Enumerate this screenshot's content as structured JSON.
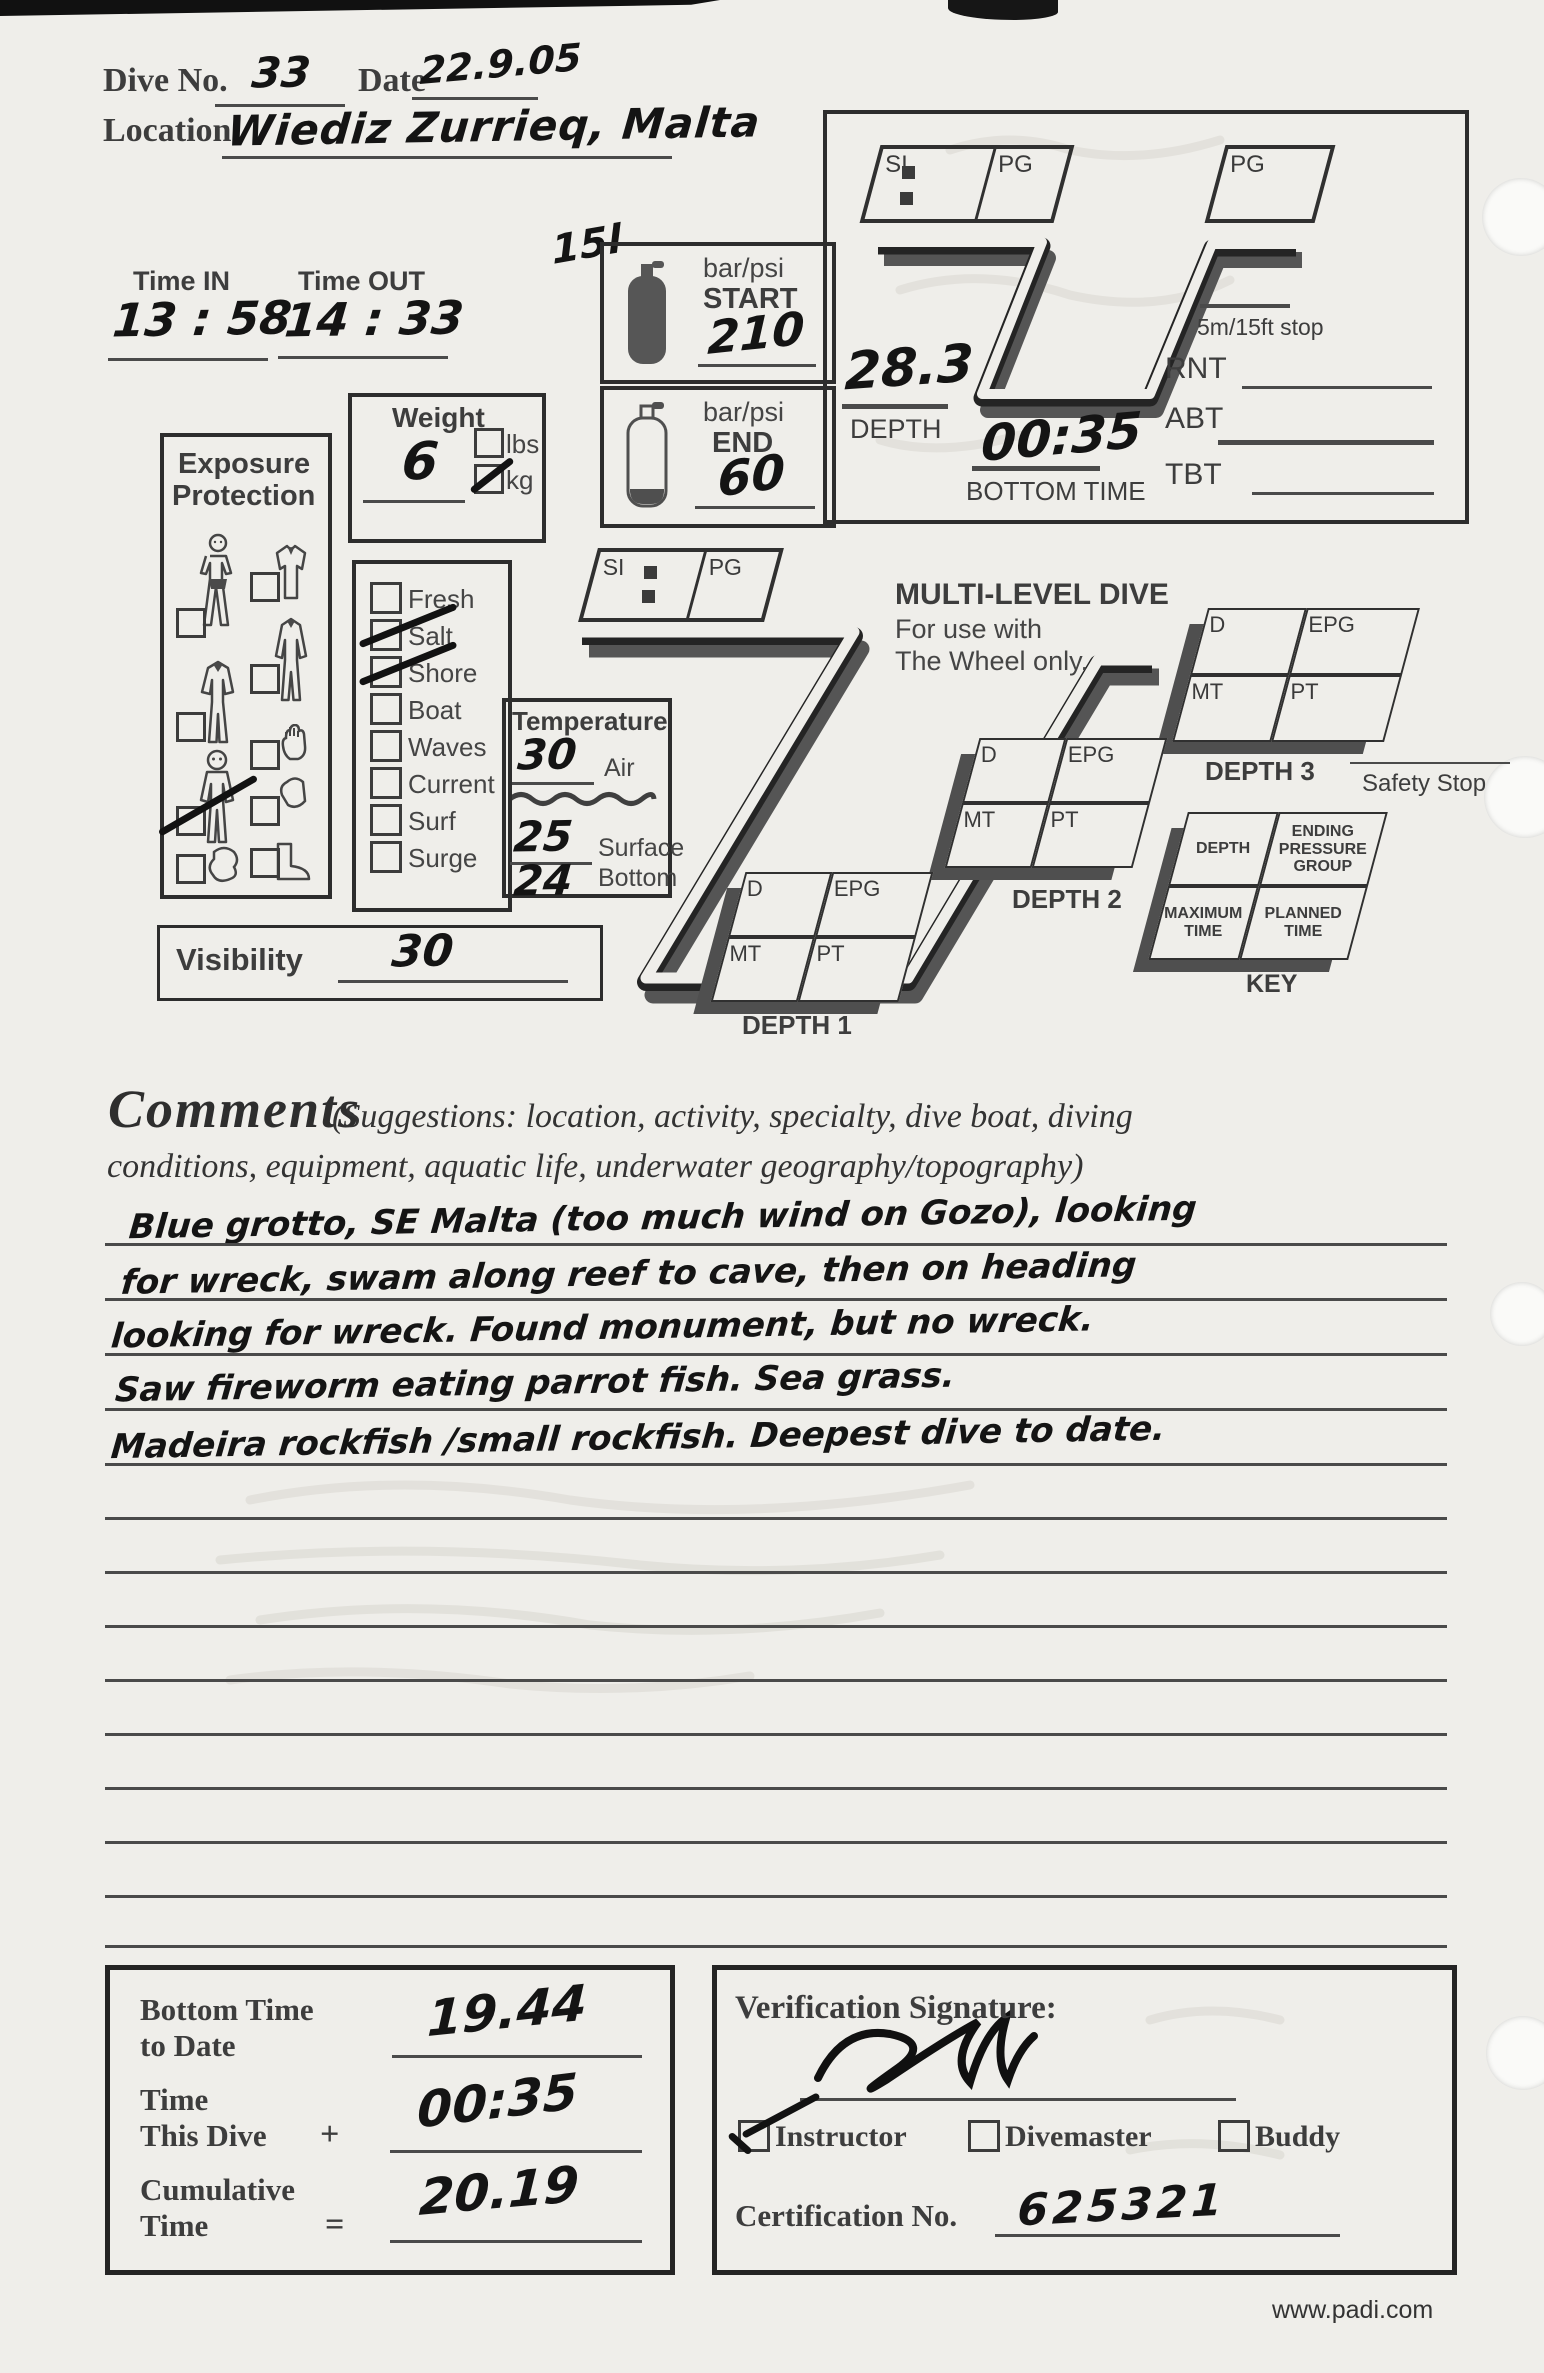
{
  "header": {
    "dive_no_label": "Dive No.",
    "dive_no_value": "33",
    "date_label": "Date",
    "date_value": "22.9.05",
    "location_label": "Location",
    "location_value": "Wiediz Zurrieq, Malta"
  },
  "times": {
    "in_label": "Time IN",
    "in_value": "13 : 58",
    "out_label": "Time OUT",
    "out_value": "14 : 33"
  },
  "tank": {
    "unit_label": "bar/psi",
    "start_label": "START",
    "start_value": "210",
    "end_label": "END",
    "end_value": "60",
    "size_note": "15l"
  },
  "weight": {
    "label": "Weight",
    "value": "6",
    "lbs_label": "lbs",
    "kg_label": "kg",
    "kg_checked": true,
    "lbs_checked": false
  },
  "exposure": {
    "title_line1": "Exposure",
    "title_line2": "Protection",
    "suit_checked": true
  },
  "conditions": {
    "items": [
      {
        "label": "Fresh",
        "checked": false
      },
      {
        "label": "Salt",
        "checked": true
      },
      {
        "label": "Shore",
        "checked": true
      },
      {
        "label": "Boat",
        "checked": false
      },
      {
        "label": "Waves",
        "checked": false
      },
      {
        "label": "Current",
        "checked": false
      },
      {
        "label": "Surf",
        "checked": false
      },
      {
        "label": "Surge",
        "checked": false
      }
    ]
  },
  "temperature": {
    "title": "Temperature",
    "air_value": "30",
    "air_label": "Air",
    "surface_value": "25",
    "surface_label": "Surface",
    "bottom_value": "24",
    "bottom_label": "Bottom"
  },
  "visibility": {
    "label": "Visibility",
    "value": "30"
  },
  "profile": {
    "si_label": "SI",
    "pg_label": "PG",
    "depth_value": "28.3",
    "depth_label": "DEPTH",
    "bottom_time_value": "00:35",
    "bottom_time_label": "BOTTOM TIME",
    "stop_label": "5m/15ft stop",
    "rnt_label": "RNT",
    "abt_label": "ABT",
    "tbt_label": "TBT"
  },
  "multilevel": {
    "title": "MULTI-LEVEL DIVE",
    "subtitle1": "For use with",
    "subtitle2": "The Wheel only.",
    "d_label": "D",
    "epg_label": "EPG",
    "mt_label": "MT",
    "pt_label": "PT",
    "depth1_label": "DEPTH 1",
    "depth2_label": "DEPTH 2",
    "depth3_label": "DEPTH 3",
    "safety_stop_label": "Safety Stop",
    "key": {
      "depth": "DEPTH",
      "epg": "ENDING PRESSURE GROUP",
      "max_time": "MAXIMUM TIME",
      "planned_time": "PLANNED TIME",
      "caption": "KEY"
    }
  },
  "comments": {
    "title": "Comments",
    "suggestions_line1": "(Suggestions: location, activity, specialty, dive boat, diving",
    "suggestions_line2": "conditions, equipment, aquatic life, underwater geography/topography)",
    "lines": [
      "Blue grotto, SE Malta (too much wind on Gozo), looking",
      "for wreck, swam along reef to cave, then on heading",
      "looking for wreck. Found monument, but no wreck.",
      "Saw fireworm eating parrot fish. Sea grass.",
      "Madeira rockfish /small rockfish. Deepest dive to date."
    ]
  },
  "totals": {
    "bottom_label1": "Bottom Time",
    "bottom_label2": "to Date",
    "bottom_value": "19.44",
    "this_label1": "Time",
    "this_label2": "This Dive",
    "plus_sign": "+",
    "this_value": "00:35",
    "cum_label1": "Cumulative",
    "cum_label2": "Time",
    "equals_sign": "=",
    "cum_value": "20.19"
  },
  "verification": {
    "title": "Verification Signature:",
    "roles": [
      {
        "label": "Instructor",
        "checked": true
      },
      {
        "label": "Divemaster",
        "checked": false
      },
      {
        "label": "Buddy",
        "checked": false
      }
    ],
    "cert_label": "Certification No.",
    "cert_value": "625321"
  },
  "footer": {
    "site": "www.padi.com"
  }
}
